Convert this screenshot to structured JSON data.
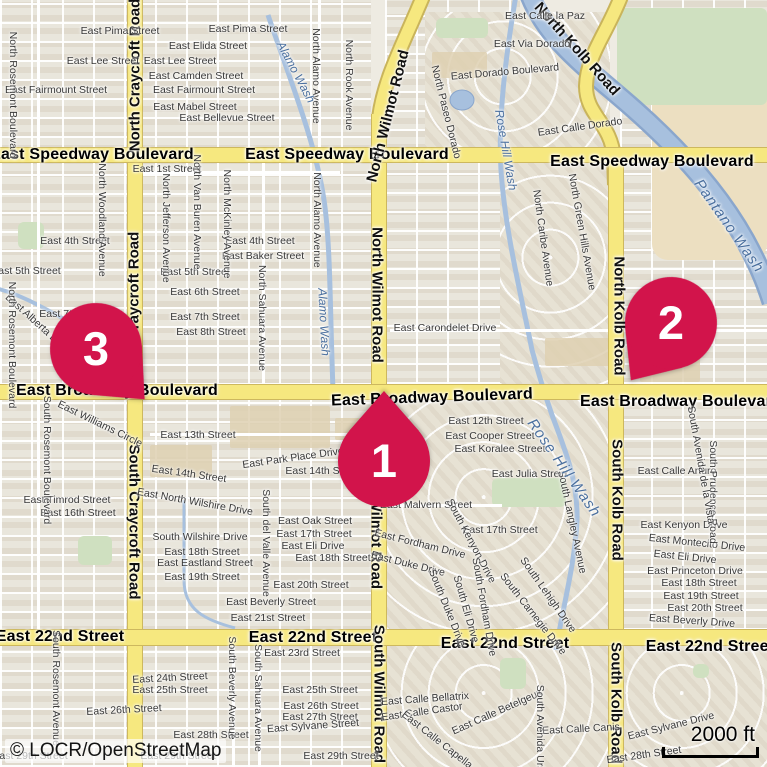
{
  "map": {
    "attribution": "© LOCR/OpenStreetMap",
    "scale_bar": {
      "label": "2000 ft"
    },
    "colors": {
      "marker": "#d2144b",
      "road_major": "#f6e87f",
      "road_casing": "#cdb85e",
      "water": "#a7c0de",
      "water_casing": "#8aa6cc",
      "land": "#eeebe2",
      "green": "#cfe0c0",
      "sand": "#ecdfc1"
    },
    "markers": [
      {
        "label": "1",
        "x": 384,
        "y": 461,
        "rot": 180
      },
      {
        "label": "2",
        "x": 671,
        "y": 323,
        "rot": 35
      },
      {
        "label": "3",
        "x": 96,
        "y": 349,
        "rot": -44
      }
    ],
    "labels": [
      {
        "t": "East Speedway Boulevard",
        "x": 92,
        "y": 155,
        "r": 0,
        "k": "major"
      },
      {
        "t": "East Speedway Boulevard",
        "x": 347,
        "y": 155,
        "r": 0,
        "k": "major"
      },
      {
        "t": "East Speedway Boulevard",
        "x": 652,
        "y": 162,
        "r": 0,
        "k": "major"
      },
      {
        "t": "East Broadway Boulevard",
        "x": 117,
        "y": 391,
        "r": 0,
        "k": "major"
      },
      {
        "t": "East Broadway Boulevard",
        "x": 432,
        "y": 398,
        "r": -2,
        "k": "major"
      },
      {
        "t": "East Broadway Boulevard",
        "x": 681,
        "y": 402,
        "r": 0,
        "k": "major"
      },
      {
        "t": "East 22nd Street",
        "x": 60,
        "y": 637,
        "r": 0,
        "k": "major"
      },
      {
        "t": "East 22nd Street",
        "x": 313,
        "y": 638,
        "r": 0,
        "k": "major"
      },
      {
        "t": "East 22nd Street",
        "x": 505,
        "y": 644,
        "r": 0,
        "k": "major"
      },
      {
        "t": "East 22nd Street",
        "x": 710,
        "y": 647,
        "r": 0,
        "k": "major"
      },
      {
        "t": "North Craycroft Road",
        "x": 135,
        "y": 75,
        "r": -90,
        "k": "road"
      },
      {
        "t": "North Craycroft Road",
        "x": 134,
        "y": 308,
        "r": -90,
        "k": "road"
      },
      {
        "t": "South Craycroft Road",
        "x": 134,
        "y": 522,
        "r": 90,
        "k": "road"
      },
      {
        "t": "North Wilmot Road",
        "x": 388,
        "y": 116,
        "r": -76,
        "k": "road"
      },
      {
        "t": "North Wilmot Road",
        "x": 377,
        "y": 295,
        "r": 90,
        "k": "road"
      },
      {
        "t": "South Wilmot Road",
        "x": 376,
        "y": 520,
        "r": 90,
        "k": "road"
      },
      {
        "t": "South Wilmot Road",
        "x": 379,
        "y": 694,
        "r": 90,
        "k": "road"
      },
      {
        "t": "North Kolb Road",
        "x": 577,
        "y": 49,
        "r": 48,
        "k": "road"
      },
      {
        "t": "North Kolb Road",
        "x": 619,
        "y": 316,
        "r": 90,
        "k": "road"
      },
      {
        "t": "South Kolb Road",
        "x": 617,
        "y": 500,
        "r": 90,
        "k": "road"
      },
      {
        "t": "South Kolb Road",
        "x": 616,
        "y": 703,
        "r": 90,
        "k": "road"
      },
      {
        "t": "East Pima Street",
        "x": 120,
        "y": 31,
        "r": 0,
        "k": "street"
      },
      {
        "t": "East Pima Street",
        "x": 248,
        "y": 29,
        "r": 0,
        "k": "street"
      },
      {
        "t": "East Lee Street",
        "x": 103,
        "y": 61,
        "r": 0,
        "k": "street"
      },
      {
        "t": "East Lee Street",
        "x": 180,
        "y": 61,
        "r": 0,
        "k": "street"
      },
      {
        "t": "East Elida Street",
        "x": 208,
        "y": 46,
        "r": 0,
        "k": "street"
      },
      {
        "t": "East Camden Street",
        "x": 196,
        "y": 76,
        "r": 0,
        "k": "street"
      },
      {
        "t": "East Fairmount Street",
        "x": 56,
        "y": 90,
        "r": 0,
        "k": "street"
      },
      {
        "t": "East Fairmount Street",
        "x": 204,
        "y": 90,
        "r": 0,
        "k": "street"
      },
      {
        "t": "East Mabel Street",
        "x": 195,
        "y": 107,
        "r": 0,
        "k": "street"
      },
      {
        "t": "East Bellevue Street",
        "x": 227,
        "y": 118,
        "r": 0,
        "k": "street"
      },
      {
        "t": "East 1st Street",
        "x": 167,
        "y": 169,
        "r": 0,
        "k": "street"
      },
      {
        "t": "East 4th Street",
        "x": 75,
        "y": 241,
        "r": 0,
        "k": "street"
      },
      {
        "t": "East 4th Street",
        "x": 260,
        "y": 241,
        "r": 0,
        "k": "street"
      },
      {
        "t": "East Baker Street",
        "x": 263,
        "y": 256,
        "r": 0,
        "k": "street"
      },
      {
        "t": "East 5th Street",
        "x": 26,
        "y": 271,
        "r": 0,
        "k": "street"
      },
      {
        "t": "East 5th Street",
        "x": 195,
        "y": 272,
        "r": 0,
        "k": "street"
      },
      {
        "t": "East 6th Street",
        "x": 205,
        "y": 292,
        "r": 0,
        "k": "street"
      },
      {
        "t": "East 7th Street",
        "x": 74,
        "y": 314,
        "r": 0,
        "k": "street"
      },
      {
        "t": "East 7th Street",
        "x": 205,
        "y": 317,
        "r": 0,
        "k": "street"
      },
      {
        "t": "East 8th Street",
        "x": 211,
        "y": 332,
        "r": 0,
        "k": "street"
      },
      {
        "t": "East Alberta Drive",
        "x": 38,
        "y": 324,
        "r": 42,
        "k": "street"
      },
      {
        "t": "East Carondelet Drive",
        "x": 445,
        "y": 328,
        "r": 0,
        "k": "street"
      },
      {
        "t": "East Calle la Paz",
        "x": 545,
        "y": 16,
        "r": 0,
        "k": "street"
      },
      {
        "t": "East Via Dorado",
        "x": 532,
        "y": 44,
        "r": 0,
        "k": "street"
      },
      {
        "t": "East Dorado Boulevard",
        "x": 505,
        "y": 72,
        "r": -5,
        "k": "street"
      },
      {
        "t": "East Calle Dorado",
        "x": 580,
        "y": 127,
        "r": -8,
        "k": "street"
      },
      {
        "t": "East 12th Street",
        "x": 486,
        "y": 421,
        "r": 0,
        "k": "street"
      },
      {
        "t": "East Cooper Street",
        "x": 490,
        "y": 436,
        "r": 0,
        "k": "street"
      },
      {
        "t": "East Koralee Street",
        "x": 500,
        "y": 449,
        "r": 0,
        "k": "street"
      },
      {
        "t": "East Julia Street",
        "x": 530,
        "y": 474,
        "r": 0,
        "k": "street"
      },
      {
        "t": "East Malvern Street",
        "x": 426,
        "y": 505,
        "r": 0,
        "k": "street"
      },
      {
        "t": "East 17th Street",
        "x": 500,
        "y": 530,
        "r": 0,
        "k": "street"
      },
      {
        "t": "East Calle Arturo",
        "x": 677,
        "y": 471,
        "r": 0,
        "k": "street"
      },
      {
        "t": "East Kenyon Drive",
        "x": 684,
        "y": 525,
        "r": 0,
        "k": "street"
      },
      {
        "t": "East Montecito Drive",
        "x": 697,
        "y": 543,
        "r": 6,
        "k": "street"
      },
      {
        "t": "East Eli Drive",
        "x": 685,
        "y": 557,
        "r": 6,
        "k": "street"
      },
      {
        "t": "East Princeton Drive",
        "x": 695,
        "y": 571,
        "r": 0,
        "k": "street"
      },
      {
        "t": "East 18th Street",
        "x": 699,
        "y": 583,
        "r": 0,
        "k": "street"
      },
      {
        "t": "East 19th Street",
        "x": 701,
        "y": 596,
        "r": 0,
        "k": "street"
      },
      {
        "t": "East 20th Street",
        "x": 705,
        "y": 608,
        "r": 0,
        "k": "street"
      },
      {
        "t": "East Beverly Drive",
        "x": 692,
        "y": 621,
        "r": 4,
        "k": "street"
      },
      {
        "t": "East Park Place Drive",
        "x": 293,
        "y": 458,
        "r": -8,
        "k": "street"
      },
      {
        "t": "East 14th Street",
        "x": 189,
        "y": 474,
        "r": 8,
        "k": "street"
      },
      {
        "t": "East 14th Street",
        "x": 323,
        "y": 471,
        "r": 0,
        "k": "street"
      },
      {
        "t": "East North Wilshire Drive",
        "x": 195,
        "y": 502,
        "r": 10,
        "k": "street"
      },
      {
        "t": "East 13th Street",
        "x": 198,
        "y": 435,
        "r": 0,
        "k": "street"
      },
      {
        "t": "East Williams Circle",
        "x": 100,
        "y": 424,
        "r": 26,
        "k": "street"
      },
      {
        "t": "East Timrod Street",
        "x": 67,
        "y": 500,
        "r": 0,
        "k": "street"
      },
      {
        "t": "East 16th Street",
        "x": 78,
        "y": 513,
        "r": 0,
        "k": "street"
      },
      {
        "t": "South Wilshire Drive",
        "x": 200,
        "y": 537,
        "r": 0,
        "k": "street"
      },
      {
        "t": "East 18th Street",
        "x": 202,
        "y": 552,
        "r": 0,
        "k": "street"
      },
      {
        "t": "East Eastland Street",
        "x": 205,
        "y": 563,
        "r": 0,
        "k": "street"
      },
      {
        "t": "East 19th Street",
        "x": 202,
        "y": 577,
        "r": 0,
        "k": "street"
      },
      {
        "t": "East Oak Street",
        "x": 315,
        "y": 521,
        "r": 0,
        "k": "street"
      },
      {
        "t": "East 17th Street",
        "x": 314,
        "y": 534,
        "r": 0,
        "k": "street"
      },
      {
        "t": "East Eli Drive",
        "x": 313,
        "y": 546,
        "r": 0,
        "k": "street"
      },
      {
        "t": "East 18th Street",
        "x": 333,
        "y": 558,
        "r": 0,
        "k": "street"
      },
      {
        "t": "East 20th Street",
        "x": 311,
        "y": 585,
        "r": 0,
        "k": "street"
      },
      {
        "t": "East Beverly Street",
        "x": 271,
        "y": 602,
        "r": 0,
        "k": "street"
      },
      {
        "t": "East 21st Street",
        "x": 268,
        "y": 618,
        "r": 0,
        "k": "street"
      },
      {
        "t": "East Fordham Drive",
        "x": 420,
        "y": 544,
        "r": 14,
        "k": "street"
      },
      {
        "t": "East Duke Drive",
        "x": 408,
        "y": 564,
        "r": 14,
        "k": "street"
      },
      {
        "t": "East 23rd Street",
        "x": 302,
        "y": 653,
        "r": 0,
        "k": "street"
      },
      {
        "t": "East 24th Street",
        "x": 170,
        "y": 678,
        "r": -3,
        "k": "street"
      },
      {
        "t": "East 25th Street",
        "x": 170,
        "y": 690,
        "r": 0,
        "k": "street"
      },
      {
        "t": "East 25th Street",
        "x": 320,
        "y": 690,
        "r": 0,
        "k": "street"
      },
      {
        "t": "East 26th Street",
        "x": 124,
        "y": 710,
        "r": -3,
        "k": "street"
      },
      {
        "t": "East 26th Street",
        "x": 321,
        "y": 706,
        "r": 0,
        "k": "street"
      },
      {
        "t": "East 27th Street",
        "x": 320,
        "y": 717,
        "r": 0,
        "k": "street"
      },
      {
        "t": "East Sylvane Street",
        "x": 313,
        "y": 726,
        "r": -4,
        "k": "street"
      },
      {
        "t": "East 28th Street",
        "x": 211,
        "y": 735,
        "r": 0,
        "k": "street"
      },
      {
        "t": "East 29th Street",
        "x": 30,
        "y": 756,
        "r": 0,
        "k": "street"
      },
      {
        "t": "East 29th Street",
        "x": 178,
        "y": 756,
        "r": 0,
        "k": "street"
      },
      {
        "t": "East 29th Street",
        "x": 341,
        "y": 756,
        "r": 0,
        "k": "street"
      },
      {
        "t": "East Calle Bellatrix",
        "x": 425,
        "y": 699,
        "r": -4,
        "k": "street"
      },
      {
        "t": "East Calle Castor",
        "x": 422,
        "y": 712,
        "r": -8,
        "k": "street"
      },
      {
        "t": "East Calle Capella",
        "x": 437,
        "y": 740,
        "r": 38,
        "k": "street"
      },
      {
        "t": "East Calle Betelgeux",
        "x": 497,
        "y": 712,
        "r": -24,
        "k": "street"
      },
      {
        "t": "East Calle Canis",
        "x": 581,
        "y": 729,
        "r": -3,
        "k": "street"
      },
      {
        "t": "East Sylvane Drive",
        "x": 671,
        "y": 726,
        "r": -14,
        "k": "street"
      },
      {
        "t": "East 28th Street",
        "x": 644,
        "y": 755,
        "r": -8,
        "k": "street"
      },
      {
        "t": "North Rosemont Boulevard",
        "x": 13,
        "y": 95,
        "r": 90,
        "k": "street"
      },
      {
        "t": "North Rosemont Boulevard",
        "x": 12,
        "y": 345,
        "r": 90,
        "k": "street"
      },
      {
        "t": "South Rosemont Boulevard",
        "x": 47,
        "y": 460,
        "r": 90,
        "k": "street"
      },
      {
        "t": "South Rosemont Avenue",
        "x": 56,
        "y": 688,
        "r": 90,
        "k": "street"
      },
      {
        "t": "South Beverly Avenue",
        "x": 232,
        "y": 688,
        "r": 90,
        "k": "street"
      },
      {
        "t": "South Sahuara Avenue",
        "x": 258,
        "y": 698,
        "r": 90,
        "k": "street"
      },
      {
        "t": "North Sahuara Avenue",
        "x": 262,
        "y": 318,
        "r": 90,
        "k": "street"
      },
      {
        "t": "North Woodland Avenue",
        "x": 102,
        "y": 220,
        "r": 90,
        "k": "street"
      },
      {
        "t": "North Jefferson Avenue",
        "x": 166,
        "y": 228,
        "r": 90,
        "k": "street"
      },
      {
        "t": "North Van Buren Avenue",
        "x": 197,
        "y": 212,
        "r": 90,
        "k": "street"
      },
      {
        "t": "North McKinley Avenue",
        "x": 227,
        "y": 224,
        "r": 90,
        "k": "street"
      },
      {
        "t": "North Alamo Avenue",
        "x": 316,
        "y": 76,
        "r": 90,
        "k": "street"
      },
      {
        "t": "North Alamo Avenue",
        "x": 317,
        "y": 220,
        "r": 90,
        "k": "street"
      },
      {
        "t": "North Rook Avenue",
        "x": 349,
        "y": 85,
        "r": 90,
        "k": "street"
      },
      {
        "t": "North Paseo Dorado",
        "x": 446,
        "y": 112,
        "r": 76,
        "k": "street"
      },
      {
        "t": "North Caribe Avenue",
        "x": 543,
        "y": 238,
        "r": 82,
        "k": "street"
      },
      {
        "t": "North Green Hills Avenue",
        "x": 582,
        "y": 232,
        "r": 80,
        "k": "street"
      },
      {
        "t": "South Langley Avenue",
        "x": 572,
        "y": 522,
        "r": 78,
        "k": "street"
      },
      {
        "t": "South Kenyon Drive",
        "x": 471,
        "y": 541,
        "r": 62,
        "k": "street"
      },
      {
        "t": "South Duke Drive",
        "x": 447,
        "y": 608,
        "r": 68,
        "k": "street"
      },
      {
        "t": "South Eli Drive",
        "x": 466,
        "y": 609,
        "r": 74,
        "k": "street"
      },
      {
        "t": "South Fordham Drive",
        "x": 484,
        "y": 607,
        "r": 80,
        "k": "street"
      },
      {
        "t": "South del Valle Avenue",
        "x": 266,
        "y": 543,
        "r": 90,
        "k": "street"
      },
      {
        "t": "South Avenida Ursa",
        "x": 540,
        "y": 731,
        "r": 90,
        "k": "street"
      },
      {
        "t": "South Prudence Road",
        "x": 713,
        "y": 492,
        "r": 90,
        "k": "street"
      },
      {
        "t": "South Avenida de la Vista",
        "x": 701,
        "y": 465,
        "r": 80,
        "k": "street"
      },
      {
        "t": "South Lehigh Drive",
        "x": 548,
        "y": 595,
        "r": 55,
        "k": "street"
      },
      {
        "t": "South Carnegie Drive",
        "x": 533,
        "y": 614,
        "r": 52,
        "k": "street"
      },
      {
        "t": "Alamo Wash",
        "x": 296,
        "y": 72,
        "r": 62,
        "k": "wash"
      },
      {
        "t": "Alamo Wash",
        "x": 324,
        "y": 322,
        "r": 87,
        "k": "wash"
      },
      {
        "t": "Rose Hill Wash",
        "x": 506,
        "y": 150,
        "r": 80,
        "k": "wash"
      },
      {
        "t": "Rose Hill Wash",
        "x": 564,
        "y": 468,
        "r": 55,
        "k": "wash2"
      },
      {
        "t": "Pantano Wash",
        "x": 729,
        "y": 226,
        "r": 55,
        "k": "wash2"
      }
    ]
  }
}
